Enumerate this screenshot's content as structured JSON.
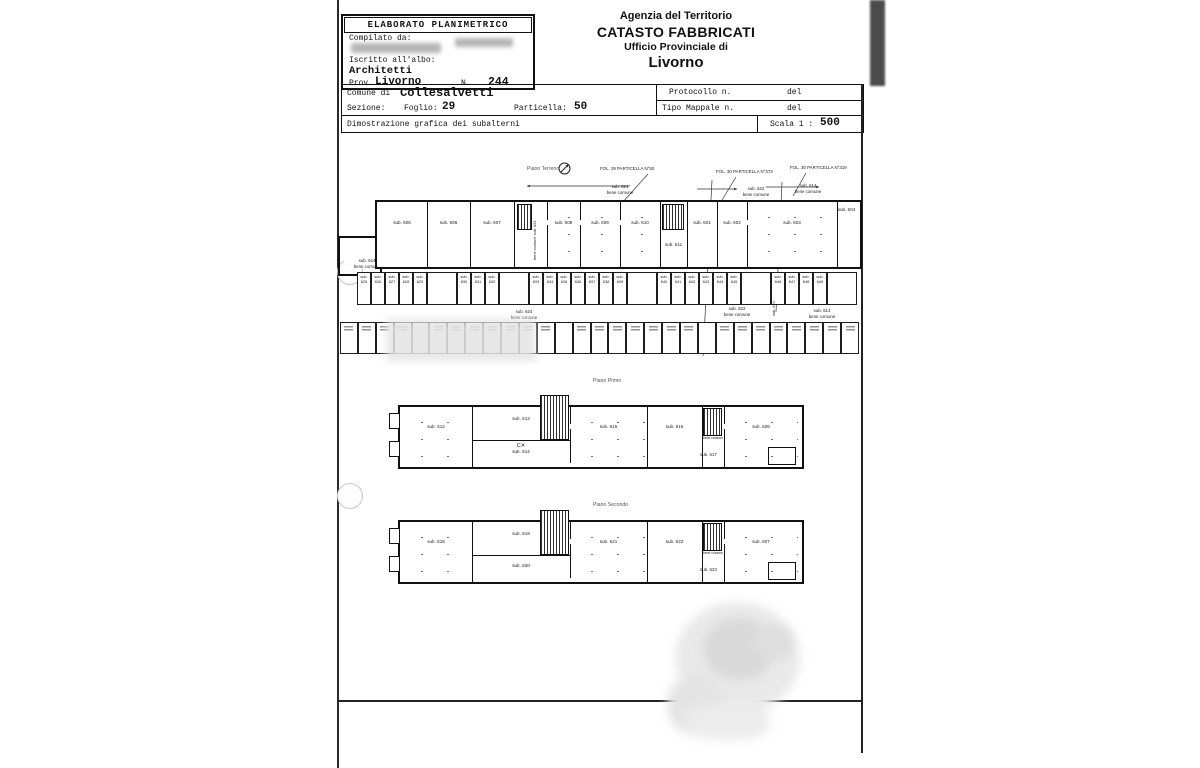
{
  "header_box": {
    "title": "ELABORATO PLANIMETRICO",
    "compilato_label": "Compilato da:",
    "iscritto_label": "Iscritto all'albo:",
    "albo_value": "Architetti",
    "prov_label": "Prov.",
    "prov_value": "Livorno",
    "n_label": "N.",
    "n_value": "244"
  },
  "agency": {
    "line1": "Agenzia del Territorio",
    "line2": "CATASTO FABBRICATI",
    "line3": "Ufficio Provinciale di",
    "line4": "Livorno"
  },
  "info_table": {
    "comune_label": "Comune di",
    "comune_value": "Collesalvetti",
    "sezione_label": "Sezione:",
    "foglio_label": "Foglio:",
    "foglio_value": "29",
    "particella_label": "Particella:",
    "particella_value": "50",
    "protocollo_label": "Protocollo n.",
    "protocollo_del": "del",
    "mappale_label": "Tipo Mappale n.",
    "mappale_del": "del",
    "dimostrazione": "Dimostrazione grafica dei subalterni",
    "scala_label": "Scala 1 :",
    "scala_value": "500"
  },
  "plans": {
    "ground": {
      "title": "Piano Terreno",
      "fol1": "FOL. 29 PARTICELLA N°50",
      "fol2": "FOL. 30 PARTICELLA N°373",
      "fol3": "FOL. 30 PARTICELLA N°319",
      "top_commons": [
        {
          "sub": "sub. 624",
          "note": "bene comune"
        },
        {
          "sub": "sub. 622",
          "note": "bene comune"
        },
        {
          "sub": "sub. 614",
          "note": "bene comune"
        }
      ],
      "left_common": {
        "sub": "sub. 624",
        "note": "bene comune"
      },
      "mid_commons": [
        {
          "sub": "sub. 624",
          "note": "bene comune"
        },
        {
          "sub": "sub. 622",
          "note": "bene comune"
        },
        {
          "sub": "sub. 614",
          "note": "bene comune"
        }
      ],
      "passage": {
        "line1": "bene comune",
        "line2": "sub. 624"
      },
      "vertical_strip": "sub. 624",
      "rooms": [
        "sub. 605",
        "sub. 606",
        "sub. 607",
        "sub. 608",
        "sub. 609",
        "sub. 610",
        "sub. 611",
        "sub. 601",
        "sub. 602",
        "sub. 603",
        "sub. 604"
      ],
      "garage_row1": [
        "sub. 625",
        "sub. 626",
        "sub. 627",
        "sub. 628",
        "sub. 629",
        "",
        "sub. 630",
        "sub. 631",
        "sub. 632",
        "",
        "sub. 633",
        "sub. 634",
        "sub. 635",
        "sub. 636",
        "sub. 637",
        "sub. 638",
        "sub. 639",
        "",
        "sub. 640",
        "sub. 641",
        "sub. 642",
        "sub. 643",
        "sub. 644",
        "sub. 645",
        "",
        "sub. 646",
        "sub. 647",
        "sub. 648",
        "sub. 649",
        ""
      ],
      "garage_row2": {
        "count": 29,
        "hatched": [
          4,
          12,
          20
        ]
      }
    },
    "first": {
      "title": "Piano Primo",
      "rooms": [
        "sub. 612",
        "sub. 613",
        "sub. 615",
        "sub. 616",
        "sub. 606"
      ],
      "common_mark": "C✕",
      "common_sub": "sub. 614",
      "stair_note": "bene comune",
      "stair_sub": "sub. 617"
    },
    "second": {
      "title": "Piano Secondo",
      "rooms": [
        "sub. 618",
        "sub. 619",
        "sub. 621",
        "sub. 622",
        "sub. 607"
      ],
      "lower_room": "sub. 620",
      "stair_note": "bene comune",
      "stair_sub": "sub. 623"
    }
  }
}
